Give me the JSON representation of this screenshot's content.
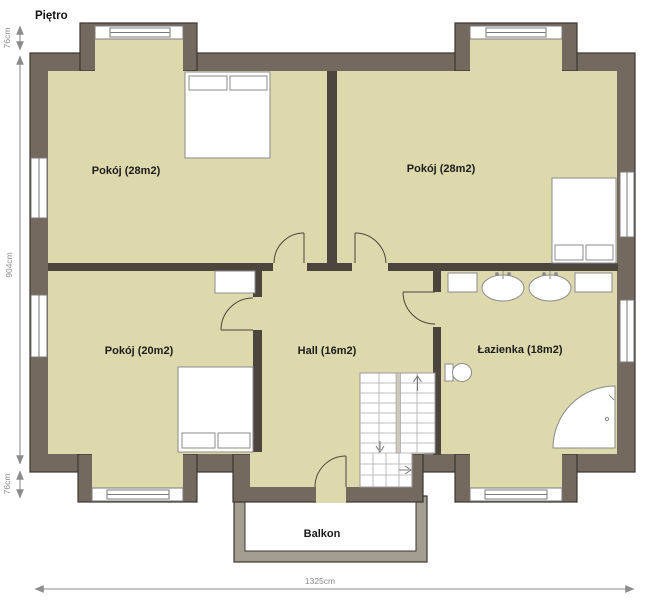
{
  "title": "Piętro",
  "rooms": [
    {
      "id": "room-top-left",
      "label": "Pokój (28m2)"
    },
    {
      "id": "room-top-right",
      "label": "Pokój (28m2)"
    },
    {
      "id": "room-bottom-left",
      "label": "Pokój (20m2)"
    },
    {
      "id": "hall",
      "label": "Hall (16m2)"
    },
    {
      "id": "bathroom",
      "label": "Łazienka (18m2)"
    },
    {
      "id": "balcony",
      "label": "Balkon"
    }
  ],
  "dimensions": {
    "left_bay_top": "76cm",
    "left_main": "904cm",
    "left_bay_bottom": "76cm",
    "bottom_total": "1325cm"
  },
  "furniture": [
    "double-bed",
    "double-bed",
    "double-bed",
    "wardrobe",
    "cabinet",
    "cabinet",
    "sink",
    "sink",
    "toilet",
    "corner-shower",
    "radiator",
    "stairs"
  ],
  "colors": {
    "exterior_wall": "#74695e",
    "wall_outline": "#3b362f",
    "interior_wall": "#4b453e",
    "floor": "#ded8ad",
    "balcony_wall": "#a49e90",
    "annotation_gray": "#8c8c8c",
    "furniture_stroke": "#8b8b8b"
  }
}
